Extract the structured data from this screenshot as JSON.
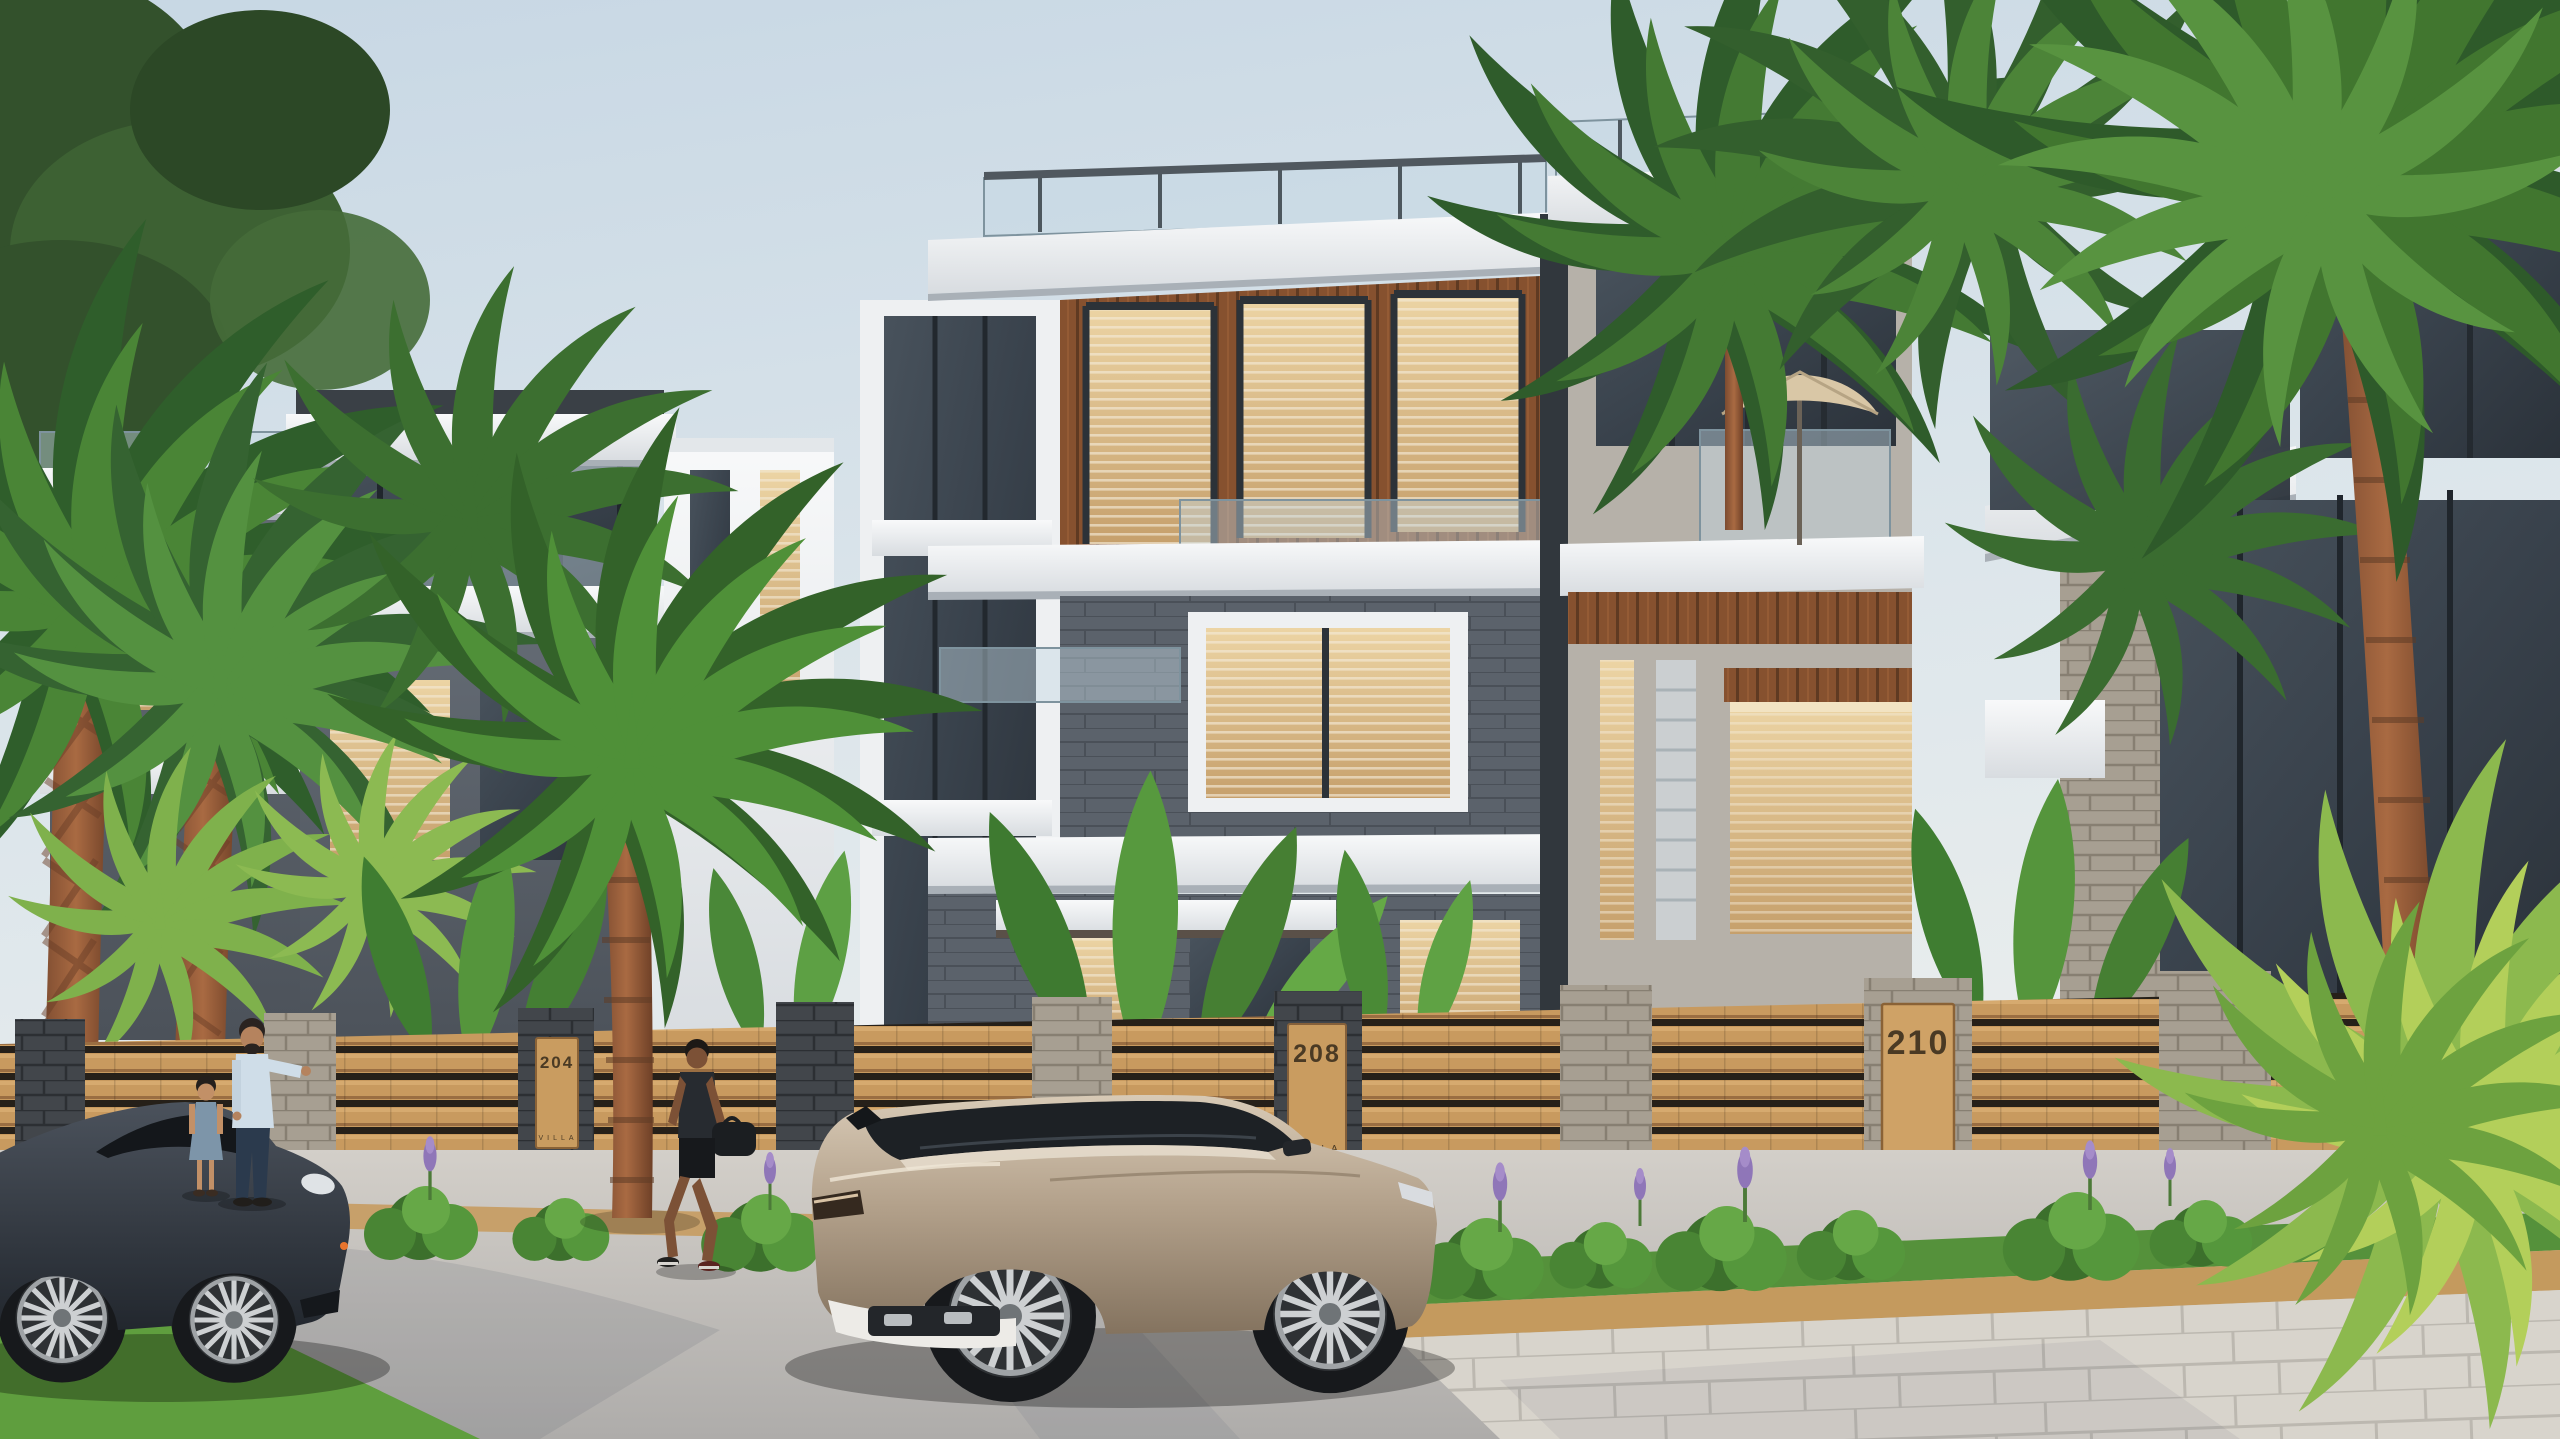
{
  "scene": {
    "description": "Sunlit 3D architectural rendering of a modern luxury villa community street: white-and-gray three-storey villas with wood accents and glass balconies, a stone-and-wood slat perimeter fence with numbered villa plaques, tropical palms, a champagne SUV and a dark sports car on the street, and pedestrians.",
    "time_of_day": "late afternoon",
    "plaques": [
      {
        "number": "204",
        "label": "VILLA"
      },
      {
        "number": "208",
        "label": "VILLA"
      },
      {
        "number": "210",
        "label": "VILLA"
      }
    ],
    "objects": {
      "vehicles": [
        "champagne-suv",
        "dark-sports-car"
      ],
      "people": [
        "man-pointing",
        "child",
        "man-walking-with-bag"
      ],
      "vegetation": [
        "sabal-palms",
        "coconut-palms",
        "fan-palms",
        "banana-plants",
        "hedge-with-purple-flowers",
        "street-tree"
      ],
      "architecture": [
        "main-villa",
        "left-villas",
        "right-villa",
        "rooftop-terraces",
        "patio-umbrella",
        "stone-and-wood-fence"
      ]
    },
    "palette": {
      "sky_top": "#c7d7e4",
      "sky_low": "#edf0ef",
      "villa_white": "#f2f4f6",
      "villa_dark_wall": "#5a616a",
      "villa_wood": "#8a5637",
      "window_warm": "#dec291",
      "fence_wood": "#c89a5f",
      "pillar_gray": "#a49c90",
      "pillar_charcoal": "#3f4347",
      "road": "#c3c0bc",
      "grass": "#5f9e3e",
      "palm_green": "#3f7a33",
      "suv_champagne": "#b4a28c",
      "sports_car": "#3a414a"
    }
  }
}
